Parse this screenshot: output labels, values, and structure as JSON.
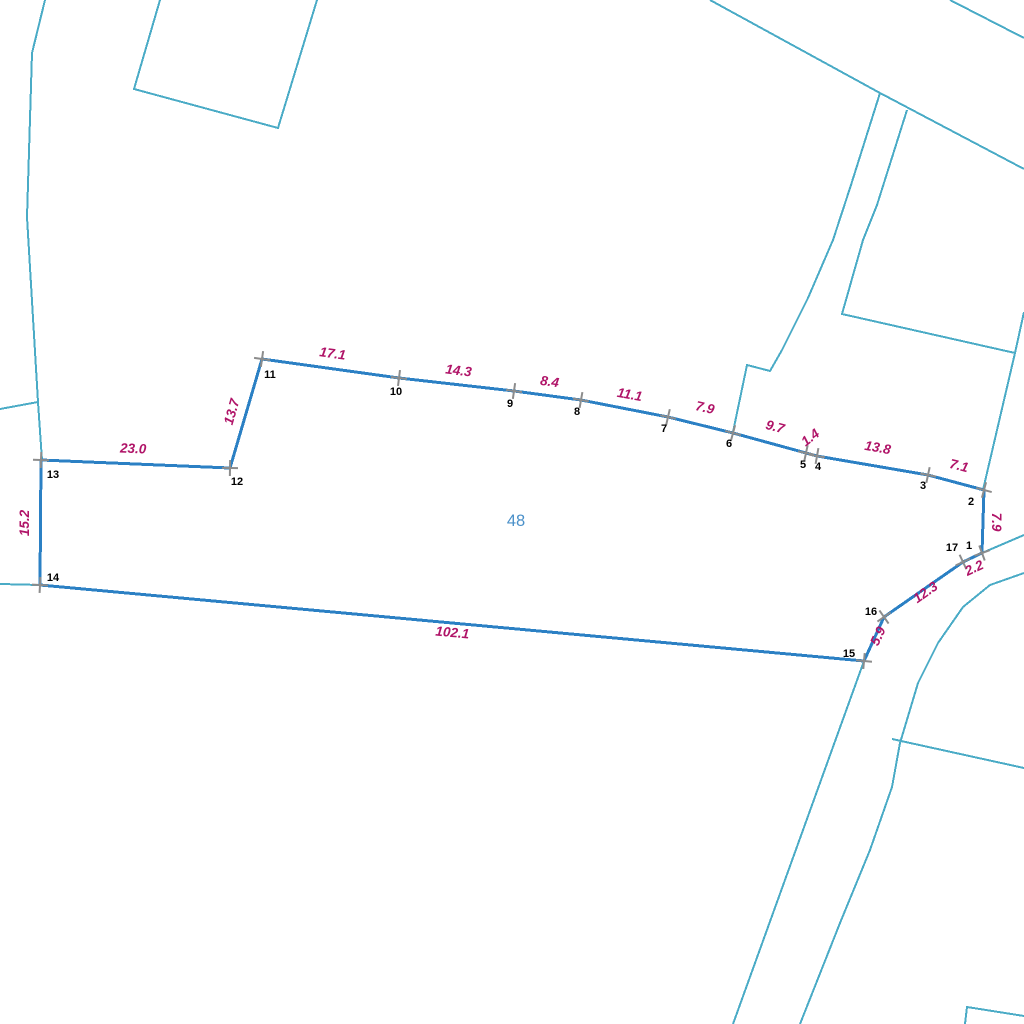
{
  "map": {
    "description": "cadastral parcel map with surveyed boundary, vertex numbers and side lengths",
    "colors": {
      "background": "#ffffff",
      "parcel_stroke": "#2b80c4",
      "background_line": "#4aabc6",
      "length_label": "#b01468",
      "vertex_label": "#000000",
      "tick": "#8c8c8c",
      "parcel_number": "#4a90c9"
    },
    "parcel_number": {
      "text": "48",
      "x": 516,
      "y": 526
    },
    "vertices": [
      {
        "n": "1",
        "x": 982,
        "y": 553,
        "label_x": 969,
        "label_y": 549,
        "tick_angle": -20
      },
      {
        "n": "2",
        "x": 984,
        "y": 490,
        "label_x": 971,
        "label_y": 505,
        "tick_angle": 15
      },
      {
        "n": "3",
        "x": 928,
        "y": 475,
        "label_x": 923,
        "label_y": 489,
        "tick_angle": 12
      },
      {
        "n": "4",
        "x": 817,
        "y": 456,
        "label_x": 818,
        "label_y": 470,
        "tick_angle": 10
      },
      {
        "n": "5",
        "x": 806,
        "y": 453,
        "label_x": 803,
        "label_y": 468,
        "tick_angle": 12
      },
      {
        "n": "6",
        "x": 733,
        "y": 433,
        "label_x": 729,
        "label_y": 447,
        "tick_angle": 15
      },
      {
        "n": "7",
        "x": 668,
        "y": 417,
        "label_x": 664,
        "label_y": 432,
        "tick_angle": 13
      },
      {
        "n": "8",
        "x": 581,
        "y": 400,
        "label_x": 577,
        "label_y": 415,
        "tick_angle": 10
      },
      {
        "n": "9",
        "x": 514,
        "y": 391,
        "label_x": 510,
        "label_y": 407,
        "tick_angle": 8
      },
      {
        "n": "10",
        "x": 399,
        "y": 378,
        "label_x": 396,
        "label_y": 395,
        "tick_angle": 7
      },
      {
        "n": "11",
        "x": 262,
        "y": 359,
        "label_x": 270,
        "label_y": 378,
        "tick_angle": 8
      },
      {
        "n": "12",
        "x": 230,
        "y": 468,
        "label_x": 237,
        "label_y": 485,
        "tick_angle": 1
      },
      {
        "n": "13",
        "x": 41,
        "y": 460,
        "label_x": 53,
        "label_y": 478,
        "tick_angle": 2
      },
      {
        "n": "14",
        "x": 40,
        "y": 585,
        "label_x": 53,
        "label_y": 581,
        "tick_angle": 3
      },
      {
        "n": "15",
        "x": 864,
        "y": 661,
        "label_x": 849,
        "label_y": 657,
        "tick_angle": 5
      },
      {
        "n": "16",
        "x": 884,
        "y": 617,
        "label_x": 871,
        "label_y": 615,
        "tick_angle": -35
      },
      {
        "n": "17",
        "x": 963,
        "y": 562,
        "label_x": 952,
        "label_y": 551,
        "tick_angle": -25
      }
    ],
    "segments": [
      {
        "from": "1",
        "to": "2",
        "length": "7.9",
        "label_x": 992,
        "label_y": 522,
        "label_angle": 90
      },
      {
        "from": "2",
        "to": "3",
        "length": "7.1",
        "label_x": 958,
        "label_y": 470,
        "label_angle": 14
      },
      {
        "from": "3",
        "to": "4",
        "length": "13.8",
        "label_x": 877,
        "label_y": 452,
        "label_angle": 10
      },
      {
        "from": "4",
        "to": "5",
        "length": "1.4",
        "label_x": 813,
        "label_y": 441,
        "label_angle": -38
      },
      {
        "from": "5",
        "to": "6",
        "length": "9.7",
        "label_x": 774,
        "label_y": 431,
        "label_angle": 15
      },
      {
        "from": "6",
        "to": "7",
        "length": "7.9",
        "label_x": 704,
        "label_y": 412,
        "label_angle": 13
      },
      {
        "from": "7",
        "to": "8",
        "length": "11.1",
        "label_x": 629,
        "label_y": 399,
        "label_angle": 10
      },
      {
        "from": "8",
        "to": "9",
        "length": "8.4",
        "label_x": 549,
        "label_y": 386,
        "label_angle": 8
      },
      {
        "from": "9",
        "to": "10",
        "length": "14.3",
        "label_x": 458,
        "label_y": 375,
        "label_angle": 7
      },
      {
        "from": "10",
        "to": "11",
        "length": "17.1",
        "label_x": 332,
        "label_y": 358,
        "label_angle": 8
      },
      {
        "from": "11",
        "to": "12",
        "length": "13.7",
        "label_x": 236,
        "label_y": 413,
        "label_angle": -74
      },
      {
        "from": "12",
        "to": "13",
        "length": "23.0",
        "label_x": 133,
        "label_y": 453,
        "label_angle": 2
      },
      {
        "from": "13",
        "to": "14",
        "length": "15.2",
        "label_x": 29,
        "label_y": 523,
        "label_angle": -90
      },
      {
        "from": "14",
        "to": "15",
        "length": "102.1",
        "label_x": 452,
        "label_y": 637,
        "label_angle": 5
      },
      {
        "from": "15",
        "to": "16",
        "length": "5.9",
        "label_x": 882,
        "label_y": 638,
        "label_angle": -65
      },
      {
        "from": "16",
        "to": "17",
        "length": "12.3",
        "label_x": 928,
        "label_y": 596,
        "label_angle": -35
      },
      {
        "from": "17",
        "to": "1",
        "length": "2.2",
        "label_x": 976,
        "label_y": 572,
        "label_angle": -25
      }
    ],
    "background_lines": [
      {
        "name": "boundary-west-vertical",
        "points": [
          [
            45,
            0
          ],
          [
            32,
            53
          ],
          [
            27,
            217
          ],
          [
            38,
            402
          ],
          [
            42,
            460
          ]
        ]
      },
      {
        "name": "boundary-west-lateral",
        "points": [
          [
            0,
            409
          ],
          [
            38,
            402
          ]
        ]
      },
      {
        "name": "boundary-west-from-14",
        "points": [
          [
            40,
            585
          ],
          [
            0,
            584
          ]
        ]
      },
      {
        "name": "parcel-north-west",
        "points": [
          [
            160,
            0
          ],
          [
            134,
            89
          ],
          [
            278,
            128
          ],
          [
            317,
            0
          ]
        ]
      },
      {
        "name": "road-top-right-corner",
        "points": [
          [
            950,
            0
          ],
          [
            1024,
            38
          ]
        ]
      },
      {
        "name": "road-north-east-diagonal",
        "points": [
          [
            710,
            0
          ],
          [
            880,
            93
          ],
          [
            1024,
            169
          ]
        ]
      },
      {
        "name": "lane-west-edge-to-6",
        "points": [
          [
            880,
            93
          ],
          [
            851,
            185
          ],
          [
            833,
            240
          ],
          [
            808,
            298
          ],
          [
            782,
            350
          ],
          [
            770,
            371
          ],
          [
            747,
            365
          ],
          [
            733,
            432
          ]
        ]
      },
      {
        "name": "lane-east-edge",
        "points": [
          [
            907,
            110
          ],
          [
            877,
            205
          ],
          [
            863,
            240
          ],
          [
            842,
            314
          ],
          [
            1015,
            353
          ]
        ]
      },
      {
        "name": "boundary-east-to-2",
        "points": [
          [
            1024,
            312
          ],
          [
            1015,
            353
          ],
          [
            983,
            490
          ]
        ]
      },
      {
        "name": "road-east-upper-edge-to-1",
        "points": [
          [
            1024,
            535
          ],
          [
            982,
            553
          ]
        ]
      },
      {
        "name": "road-east-lower-edge",
        "points": [
          [
            1024,
            573
          ],
          [
            990,
            585
          ],
          [
            963,
            607
          ],
          [
            938,
            643
          ],
          [
            918,
            683
          ],
          [
            900,
            743
          ],
          [
            892,
            787
          ],
          [
            870,
            850
          ],
          [
            840,
            923
          ],
          [
            800,
            1024
          ]
        ]
      },
      {
        "name": "road-branch-east",
        "points": [
          [
            892,
            739
          ],
          [
            1024,
            768
          ]
        ]
      },
      {
        "name": "boundary-south-from-15",
        "points": [
          [
            864,
            661
          ],
          [
            733,
            1024
          ]
        ]
      },
      {
        "name": "parcel-south-east-corner",
        "points": [
          [
            965,
            1024
          ],
          [
            967,
            1007
          ],
          [
            1024,
            1016
          ]
        ]
      }
    ]
  }
}
